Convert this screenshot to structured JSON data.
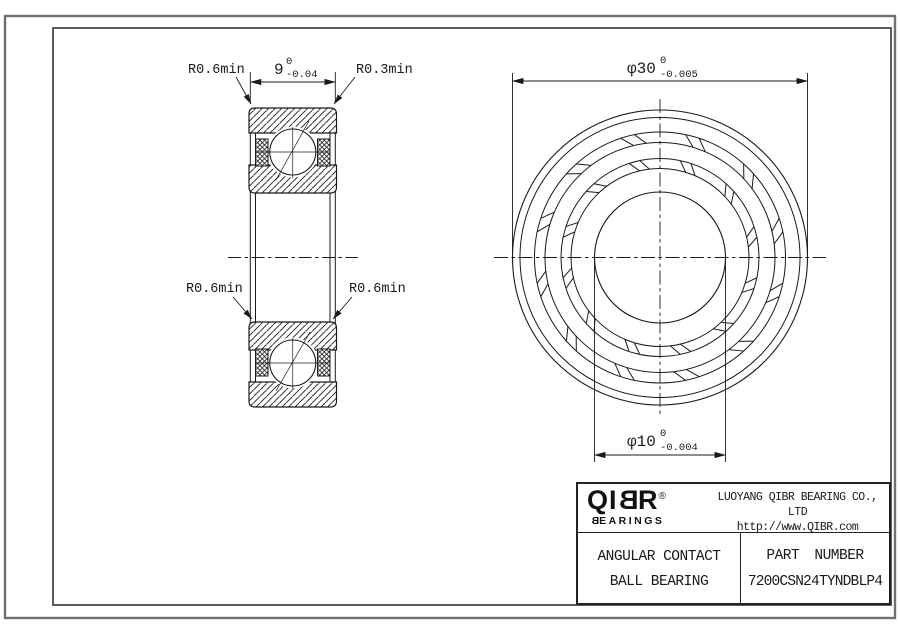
{
  "drawing": {
    "section_view": {
      "label_top_left": "R0.6min",
      "label_top_right": "R0.3min",
      "label_mid_left": "R0.6min",
      "label_mid_right": "R0.6min",
      "dim_width": {
        "text": "9",
        "sup": "0",
        "sub": "-0.04"
      }
    },
    "front_view": {
      "dim_outer_diameter": {
        "text": "φ30",
        "sup": "0",
        "sub": "-0.005"
      },
      "dim_bore_diameter": {
        "text": "φ10",
        "sup": "0",
        "sub": "-0.004"
      }
    }
  },
  "title_block": {
    "logo": {
      "q": "QI",
      "b": "B",
      "r": "R",
      "reg": "®",
      "sub_b": "B",
      "sub_rest": "EARINGS"
    },
    "company": "LUOYANG QIBR BEARING CO., LTD",
    "website": "http://www.QIBR.com",
    "product_line1": "ANGULAR CONTACT",
    "product_line2": "BALL BEARING",
    "part_number_label": "PART NUMBER",
    "part_number": "7200CSN24TYNDBLP4"
  }
}
